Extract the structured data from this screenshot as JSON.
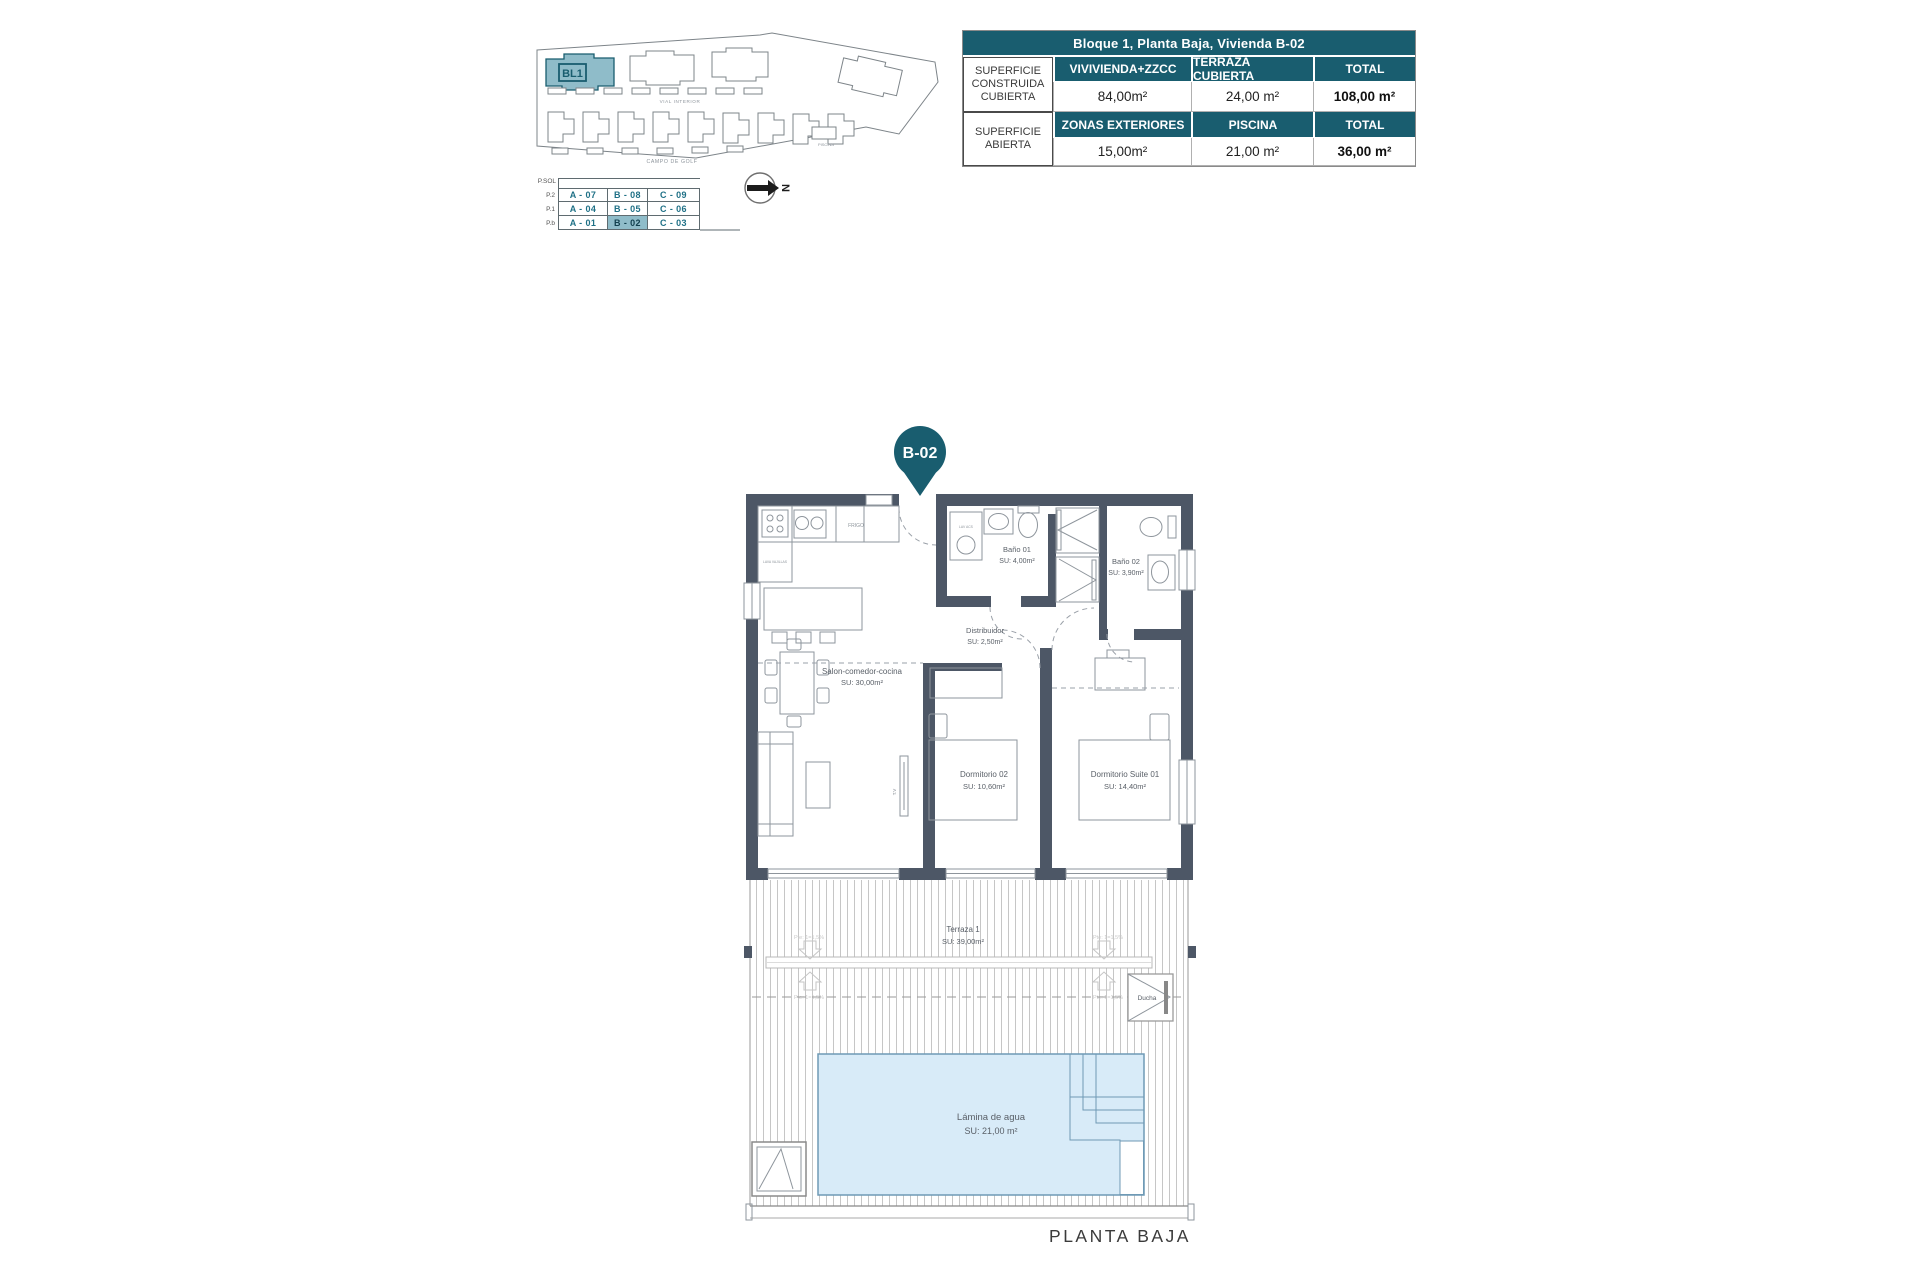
{
  "sheet": {
    "plan_caption": "PLANTA BAJA",
    "unit_pin_label": "B-02"
  },
  "site_plan": {
    "block_label": "BL1",
    "street_label": "VIAL INTERIOR",
    "bottom_label": "CAMPO DE GOLF",
    "pool_label": "PISCINA"
  },
  "level_selector": {
    "header": "P.SOL",
    "levels": [
      "P.2",
      "P.1",
      "P.b"
    ],
    "rows": [
      [
        "A - 07",
        "B - 08",
        "C - 09"
      ],
      [
        "A - 04",
        "B - 05",
        "C - 06"
      ],
      [
        "A - 01",
        "B - 02",
        "C - 03"
      ]
    ],
    "highlighted_unit": "B - 02"
  },
  "compass": {
    "north_label": "N"
  },
  "spec_table": {
    "title": "Bloque 1, Planta Baja, Vivienda B-02",
    "sections": [
      {
        "row_header": "SUPERFICIE CONSTRUIDA CUBIERTA",
        "columns": [
          "VIVIVIENDA+ZZCC",
          "TERRAZA CUBIERTA",
          "TOTAL"
        ],
        "values": [
          "84,00m²",
          "24,00 m²",
          "108,00 m²"
        ]
      },
      {
        "row_header": "SUPERFICIE ABIERTA",
        "columns": [
          "ZONAS EXTERIORES",
          "PISCINA",
          "TOTAL"
        ],
        "values": [
          "15,00m²",
          "21,00 m²",
          "36,00 m²"
        ]
      }
    ]
  },
  "floor_plan": {
    "rooms": {
      "salon": {
        "name": "Salon-comedor-cocina",
        "area": "SU: 30,00m²"
      },
      "distribuidor": {
        "name": "Distribuidor",
        "area": "SU: 2,50m²"
      },
      "bano01": {
        "name": "Baño 01",
        "area": "SU: 4,00m²"
      },
      "bano02": {
        "name": "Baño 02",
        "area": "SU: 3,90m²"
      },
      "dormitorio02": {
        "name": "Dormitorio 02",
        "area": "SU: 10,60m²"
      },
      "suite01": {
        "name": "Dormitorio Suite 01",
        "area": "SU: 14,40m²"
      },
      "terraza": {
        "name": "Terraza 1",
        "area": "SU: 39,00m²"
      },
      "lamina": {
        "name": "Lámina de agua",
        "area": "SU: 21,00 m²"
      },
      "ducha": {
        "name": "Ducha"
      }
    },
    "fixture_labels": {
      "fridge": "FRIGO",
      "dishwasher": "LAVA VAJILLAS",
      "water_heater": "LAV ACS",
      "tv": "T.V"
    },
    "slope_label": "Pte: 1=1,5%"
  },
  "colors": {
    "teal": "#195d6f",
    "teal_light": "#8fbcc9",
    "wall": "#4d5766",
    "pool_fill": "#d8ebf8",
    "pool_line": "#6f9ab5"
  }
}
